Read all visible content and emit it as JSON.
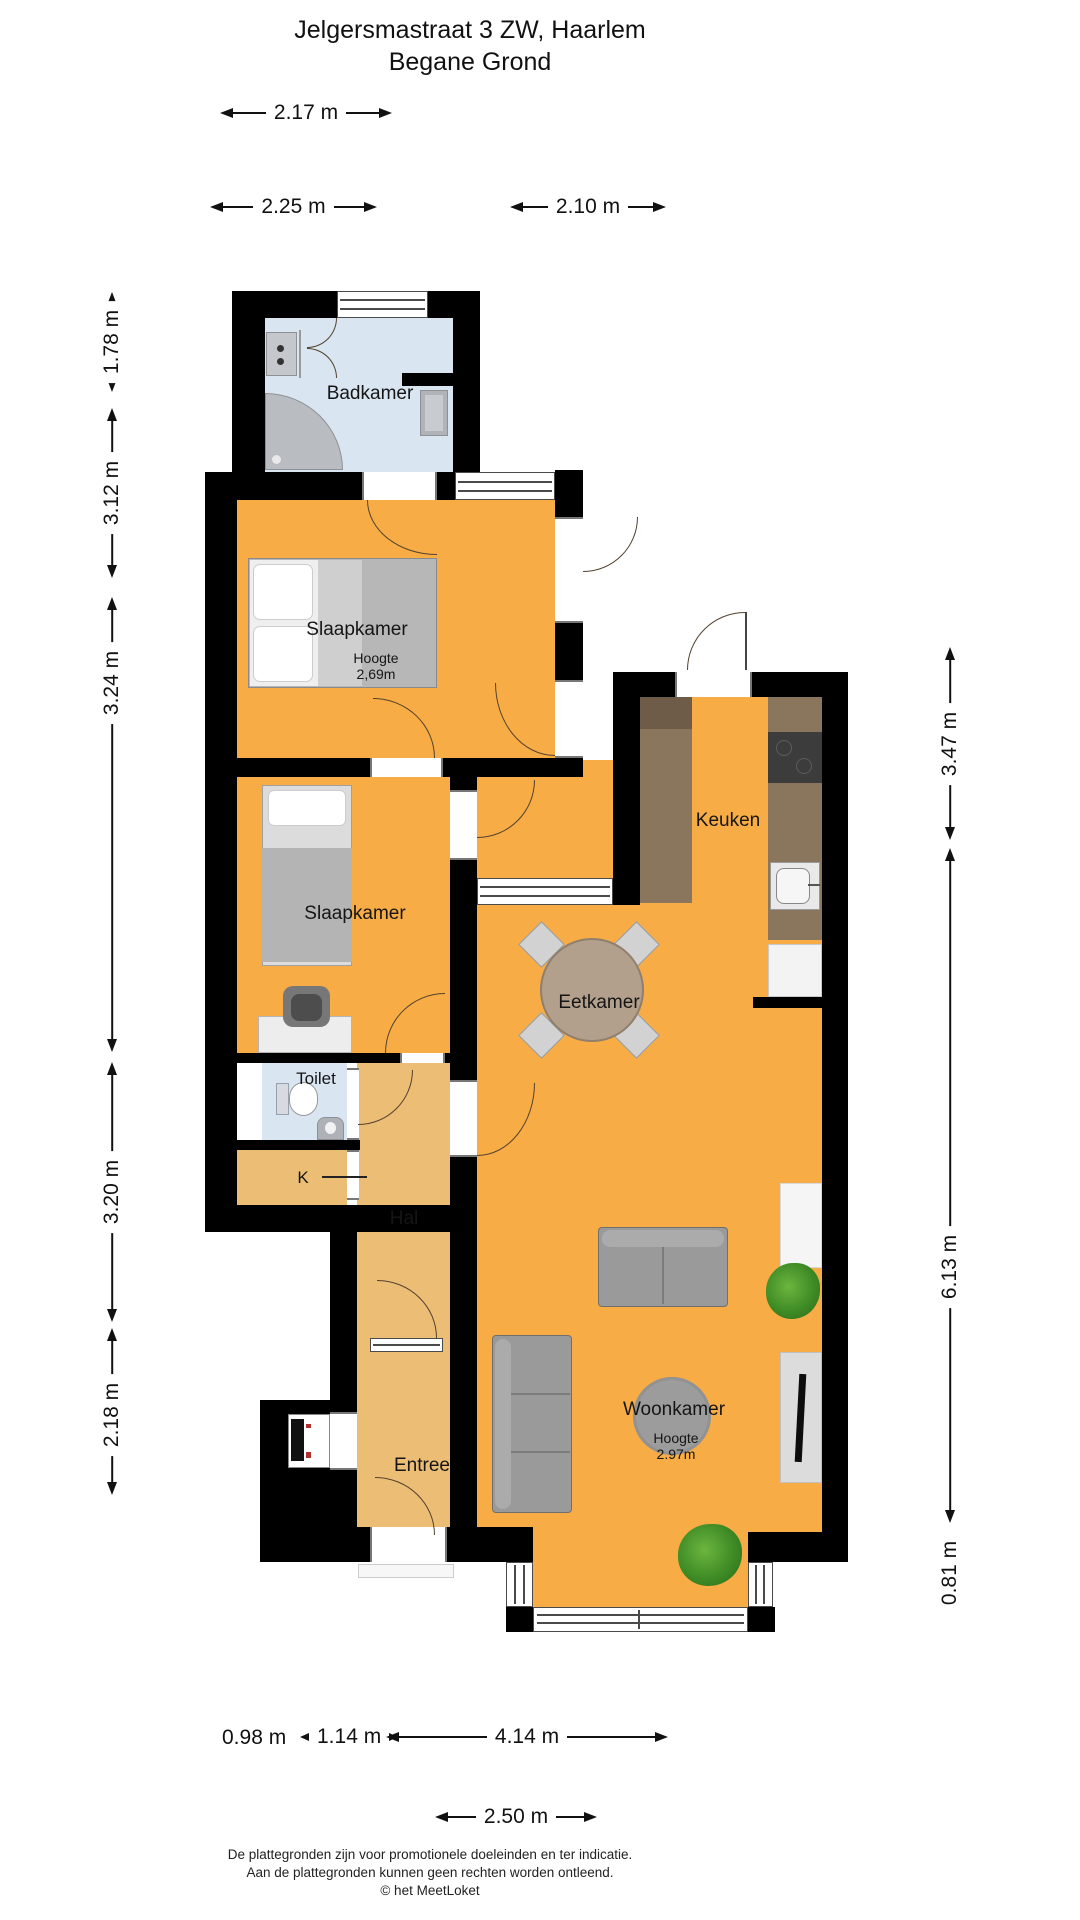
{
  "title": {
    "line1": "Jelgersmastraat 3 ZW, Haarlem",
    "line2": "Begane Grond"
  },
  "rooms": {
    "badkamer": {
      "label": "Badkamer"
    },
    "slaapkamer1": {
      "label": "Slaapkamer",
      "height_label": "Hoogte",
      "height_value": "2,69m"
    },
    "slaapkamer2": {
      "label": "Slaapkamer"
    },
    "toilet": {
      "label": "Toilet"
    },
    "kast": {
      "label": "K"
    },
    "hal": {
      "label": "Hal"
    },
    "entree": {
      "label": "Entree"
    },
    "keuken": {
      "label": "Keuken"
    },
    "eetkamer": {
      "label": "Eetkamer"
    },
    "woonkamer": {
      "label": "Woonkamer",
      "height_label": "Hoogte",
      "height_value": "2.97m"
    }
  },
  "dimensions": {
    "top": [
      "2.17 m",
      "2.25 m",
      "2.10 m"
    ],
    "left": [
      "1.78 m",
      "3.12 m",
      "3.24 m",
      "3.20 m",
      "2.18 m"
    ],
    "right": [
      "3.47 m",
      "6.13 m",
      "0.81 m"
    ],
    "bottom": [
      "0.98 m",
      "1.14 m",
      "4.14 m",
      "2.50 m"
    ]
  },
  "footer": {
    "line1": "De plattegronden zijn voor promotionele doeleinden en ter indicatie.",
    "line2": "Aan de plattegronden kunnen geen rechten worden ontleend.",
    "line3": "© het MeetLoket"
  },
  "colors": {
    "floor_orange": "#F7AC45",
    "floor_hall": "#ECBD74",
    "floor_bath": "#D9E5F1",
    "wall": "#000000",
    "counter": "#8A755D",
    "counter_dark": "#6E5C49",
    "cooktop": "#3C3C3C",
    "furniture_grey": "#9A9A9A",
    "table_wood": "#B3A08C",
    "plant_green": "#3F8C26"
  }
}
